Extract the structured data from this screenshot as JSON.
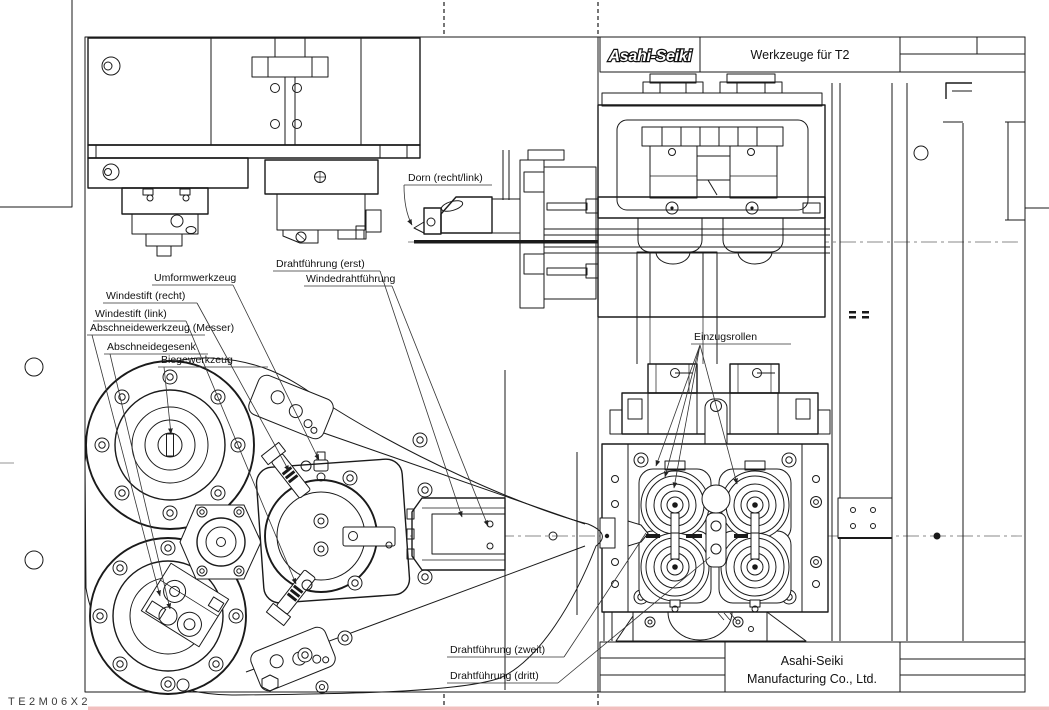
{
  "sheet": {
    "drawing_code": "TE2M06X2"
  },
  "title_block": {
    "logo_text": "Asahi-Seiki",
    "drawing_title": "Werkzeuge für T2",
    "company_name_line1": "Asahi-Seiki",
    "company_name_line2": "Manufacturing Co., Ltd."
  },
  "annotations": {
    "dorn": "Dorn (recht/link)",
    "drahtfuehrung_erst": "Drahtführung (erst)",
    "windedrahtfuehrung": "Windedrahtführung",
    "umformwerkzeug": "Umformwerkzeug",
    "windestift_recht": "Windestift (recht)",
    "windestift_link": "Windestift (link)",
    "abschneidewerkzeug_messer": "Abschneidewerkzeug (Messer)",
    "abschneidegesenk": "Abschneidegesenk",
    "biegewerkzeug": "Biegewerkzeug",
    "einzugsrollen": "Einzugsrollen",
    "drahtfuehrung_zweit": "Drahtführung (zweit)",
    "drahtfuehrung_dritt": "Drahtführung (dritt)"
  },
  "colors": {
    "drawing_line": "#1a1a1a",
    "centerline": "#8a8a8a",
    "paper": "#ffffff",
    "bottom_strip": "#f2bfbf"
  }
}
